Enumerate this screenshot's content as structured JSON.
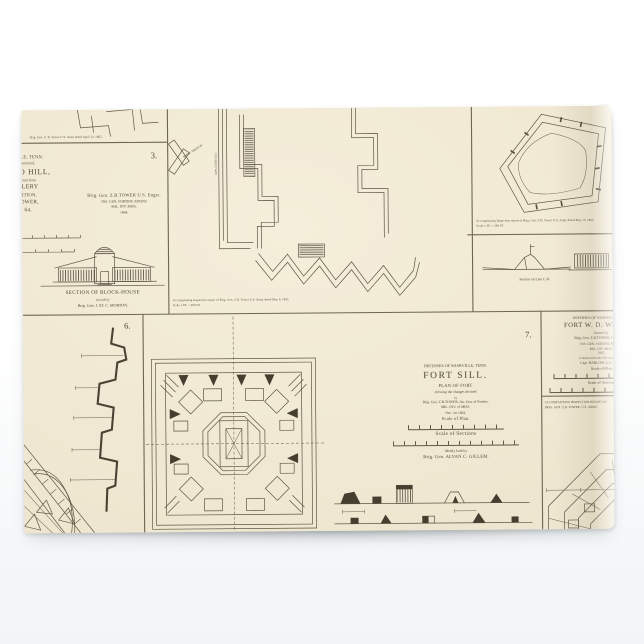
{
  "colors": {
    "paper": "#f0e8d2",
    "ink": "#4c4635",
    "panel_rule": "#6e6554",
    "background_top": "#ffffff",
    "background_bottom": "#f1f5f6",
    "fold_white": "#fbfbfa"
  },
  "panels": {
    "sliver": {
      "caption": "Brig. Gen. Z. B. Tower U.S. Army dated April 13, 1865."
    },
    "casino": {
      "number": "3.",
      "clipped_lines": [
        "VILLE, TENN.",
        "nstructed,",
        "SINO HILL,",
        "house from",
        "LLERY",
        "SITION,",
        "TOWER,",
        "64."
      ],
      "credit_lines": [
        "Brig. Gen. Z.B.TOWER U.S. Engrs.",
        "INS. GEN. FORTIFICATIONS",
        "MIL. DIV. MISS.",
        "1864."
      ],
      "blockhouse_caption": [
        "SECTION OF BLOCK-HOUSE",
        "as built by",
        "Brig. Gen. J. ST. C. MORTON."
      ]
    },
    "center_fort": {
      "caption_lines": [
        "Accompanying Inspection report of Brig. Gen. Z.B. Tower U.S. Army dated May 9, 1865.",
        "Scale 1 IN. = 400 FT."
      ],
      "work_labels": [
        "RIFLE TRENCH",
        "COVERED WAY"
      ]
    },
    "pentagon_fort": {
      "caption_lines": [
        "Accompanying Inspection report of Brig. Gen. Z.B. Tower U.S. Army dated May 13, 1865.",
        "Scale 1 IN. = 200 FT."
      ]
    },
    "section_cd": {
      "caption": "Section on Line C-D."
    },
    "profile": {
      "number": "6."
    },
    "fort_sill": {
      "number": "7.",
      "title_lines": [
        "DEFENSES OF NASHVILLE, TENN.",
        "FORT SILL.",
        "PLAN OF FORT",
        "showing the changes devised",
        "by",
        "Brig. Gen. Z.B.TOWER, Ins. Gen. of Fortfns.",
        "MIL. DIV. of MISS.",
        "Dec. 1st 1864.",
        "Scale of Plan."
      ],
      "scale_sections_label": "Scale of Sections",
      "built_lines": [
        "Mostly built by",
        "Brig. Gen. ALVAN C. GILLEM."
      ]
    },
    "whipple": {
      "title_lines": [
        "DEFENSES OF NASHVILLE, TENN.",
        "FORT W. D. WHIPPLE",
        "Planned by",
        "Brig. Gen. Z.B.TOWER, U.S. Engrs.",
        "INS. GEN. FORTIFICATIONS",
        "MIL. DIV. MISS.",
        "1865.",
        "Constructed under the direction of",
        "Capt. BARLOW, U.S. Engrs.",
        "Scale of Plan"
      ],
      "scale_sections_label": "Scale of Sections",
      "footnote_lines": [
        "ACCOMPANYING INSPECTION REPORT OF",
        "BRIG. GEN. Z.B. TOWER, U.S. ARMY."
      ]
    }
  }
}
